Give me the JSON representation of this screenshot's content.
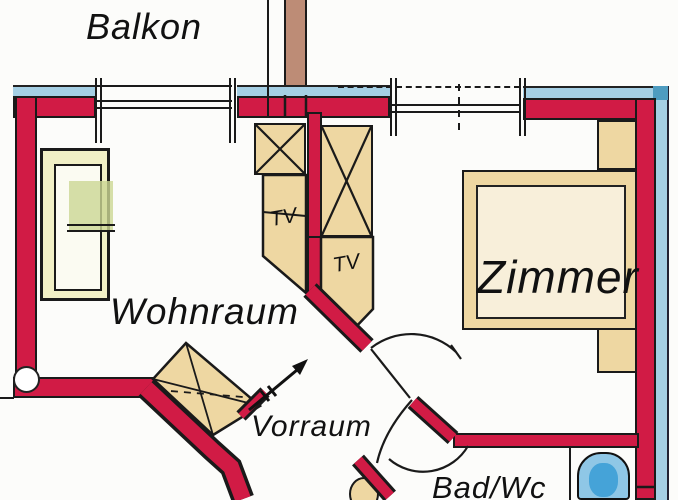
{
  "title": "Apartment floor plan",
  "rooms": {
    "balcony": "Balkon",
    "living": "Wohnraum",
    "bedroom": "Zimmer",
    "hall": "Vorraum",
    "bath": "Bad/Wc"
  },
  "labels": {
    "tv_left": "TV",
    "tv_right": "TV"
  },
  "colors": {
    "wall_red": "#d11b45",
    "outer_band_blue": "#a5cfe4",
    "corner_teal": "#4e9cc0",
    "furniture_tan": "#eed7a2",
    "bed_pale_yellow": "#f1f0c6",
    "plant_green": "#ccd794",
    "chimney_brown": "#bd8c76",
    "bathtub_blue": "#8fc7e6",
    "bathtub_water": "#45a3d8",
    "outline_black": "#1a1a1a"
  }
}
